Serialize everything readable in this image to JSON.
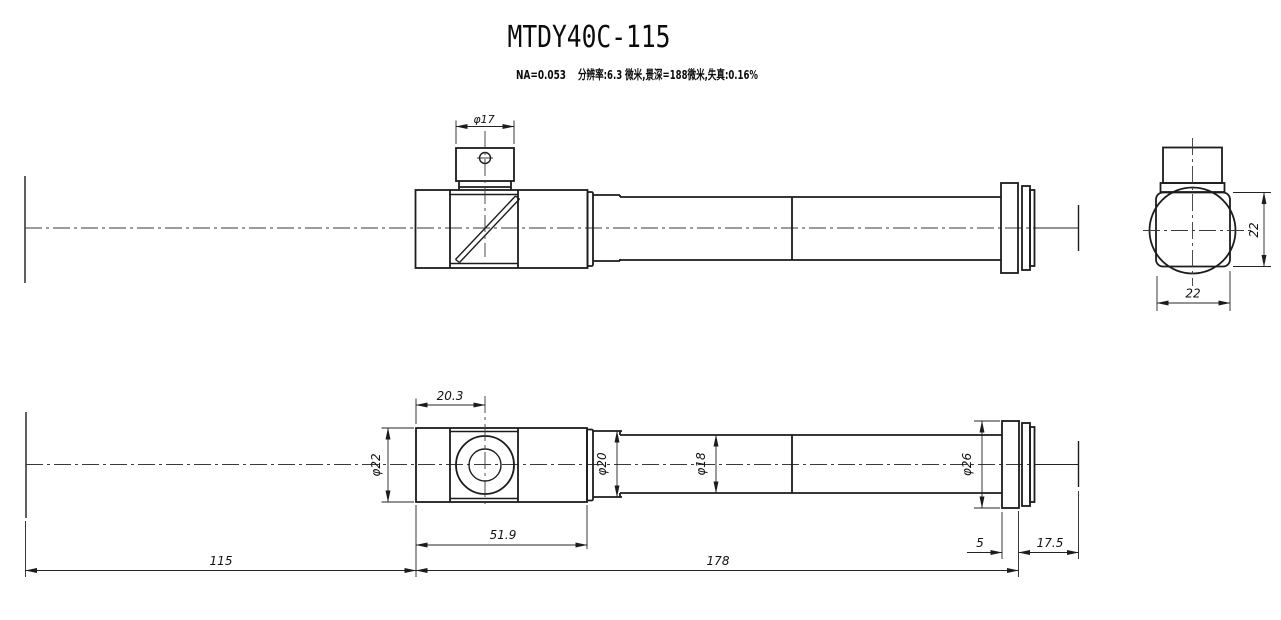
{
  "title": "MTDY40C-115",
  "subtitle": {
    "na": "NA=0.053",
    "specs": "分辨率:6.3 微米,景深=188微米,失真:0.16%"
  },
  "colors": {
    "line": "#1c1c1c",
    "background": "#ffffff"
  },
  "views": {
    "top": {
      "dims": {
        "port_diameter": "φ17"
      }
    },
    "side": {
      "dims": {
        "height": "22",
        "width": "22"
      }
    },
    "bottom": {
      "dims": {
        "port_offset": "20.3",
        "body_diameter": "φ22",
        "body_length": "51.9",
        "neck_diameter": "φ20",
        "tube_diameter": "φ18",
        "flange_diameter": "φ26",
        "flange_width": "5",
        "flange_to_image_plane": "17.5",
        "object_to_body": "115",
        "body_to_flange": "178"
      }
    }
  }
}
